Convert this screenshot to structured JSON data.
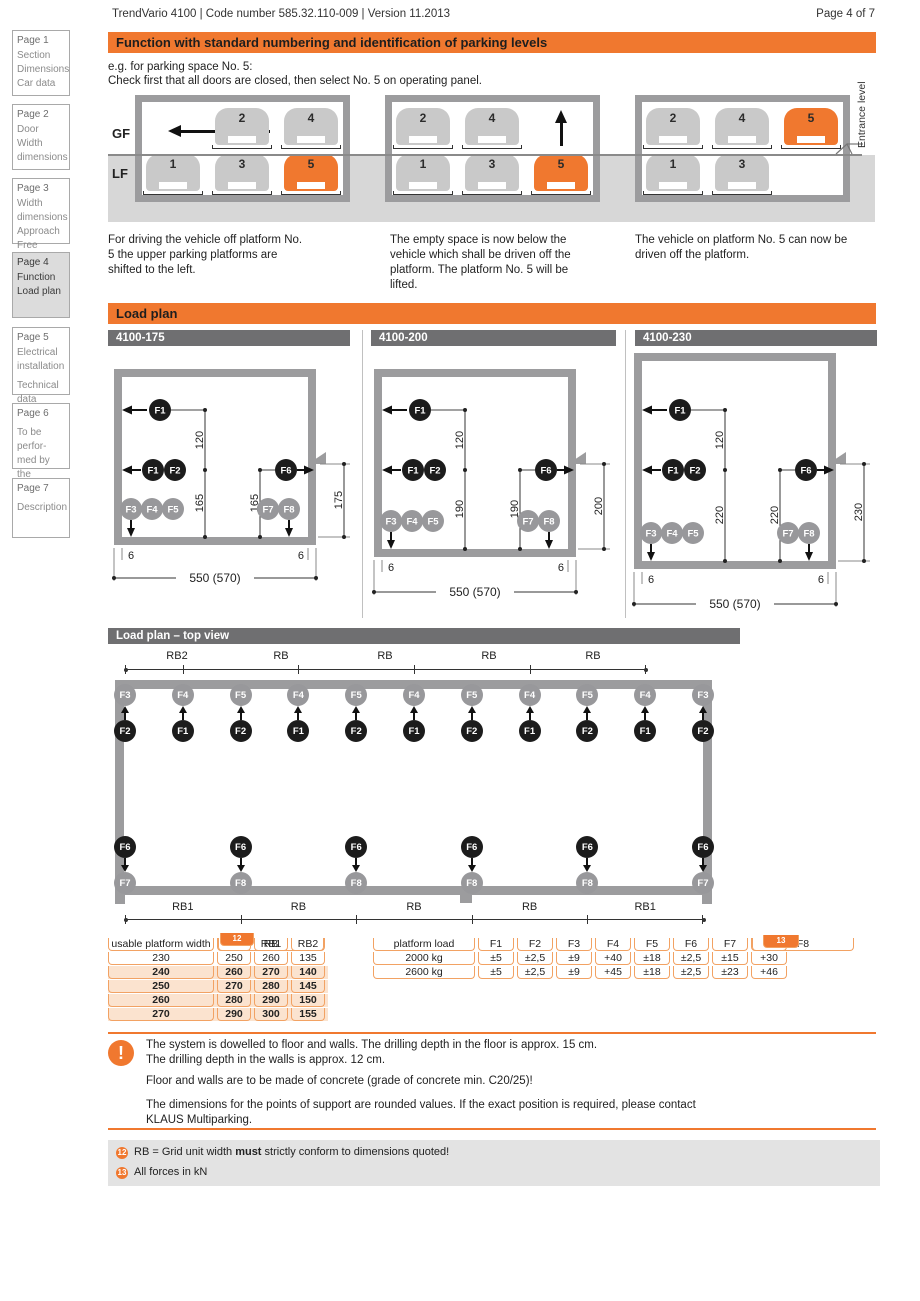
{
  "header": {
    "left": "TrendVario 4100 | Code number 585.32.110-009 | Version 11.2013",
    "right": "Page 4 of 7"
  },
  "colors": {
    "orange": "#f0782f",
    "peach": "#fbe3cf",
    "wall_gray": "#9c9c9e",
    "ground_gray": "#d7d7d7",
    "bar_gray": "#6f6f71"
  },
  "sidebar": [
    {
      "title": "Page 1",
      "lines": [
        "Section",
        "Dimensions",
        "Car data"
      ]
    },
    {
      "title": "Page 2",
      "lines": [
        "Door",
        "Width",
        "dimensions"
      ]
    },
    {
      "title": "Page 3",
      "lines": [
        "Width",
        "dimensions",
        "Approach",
        "Free spaces"
      ]
    },
    {
      "title": "Page 4",
      "lines": [
        "Function",
        "Load plan"
      ]
    },
    {
      "title": "Page 5",
      "lines": [
        "Electrical",
        "installation",
        "Technical",
        "data"
      ]
    },
    {
      "title": "Page 6",
      "lines": [
        "To be perfor-",
        "med by the",
        "customer"
      ]
    },
    {
      "title": "Page 7",
      "lines": [
        "Description"
      ]
    }
  ],
  "function": {
    "title": "Function with standard numbering and identification of parking levels",
    "intro1": "e.g. for parking space No. 5:",
    "intro2": "Check first that all doors are closed, then select No. 5 on operating panel.",
    "gf": "GF",
    "lf": "LF",
    "entrance": "Entrance level",
    "diagrams": [
      {
        "gf": [
          "2",
          "4"
        ],
        "lf": [
          "1",
          "3",
          "5"
        ]
      },
      {
        "gf": [
          "2",
          "4"
        ],
        "lf": [
          "1",
          "3",
          "5"
        ]
      },
      {
        "gf": [
          "2",
          "4",
          "5"
        ],
        "lf": [
          "1",
          "3"
        ]
      }
    ],
    "captions": [
      "For driving the vehicle off platform No. 5 the upper parking platforms are shifted to the left.",
      "The empty space is now below the vehicle which shall be driven off the platform. The platform No. 5 will be lifted.",
      "The vehicle on platform No. 5 can now be driven off the platform."
    ]
  },
  "labels": {
    "f1": "F1",
    "f2": "F2",
    "f3": "F3",
    "f4": "F4",
    "f5": "F5",
    "f6": "F6",
    "f7": "F7",
    "f8": "F8"
  },
  "loadplan": {
    "title": "Load plan",
    "panels": [
      {
        "name": "4100-175",
        "dim_gap": "120",
        "dim_left": "165",
        "dim_mid": "165",
        "dim_right": "175",
        "wall_left": "6",
        "wall_right": "6",
        "total": "550 (570)"
      },
      {
        "name": "4100-200",
        "dim_gap": "120",
        "dim_left": "190",
        "dim_mid": "190",
        "dim_right": "200",
        "wall_left": "6",
        "wall_right": "6",
        "total": "550 (570)"
      },
      {
        "name": "4100-230",
        "dim_gap": "120",
        "dim_left": "220",
        "dim_mid": "220",
        "dim_right": "230",
        "wall_left": "6",
        "wall_right": "6",
        "total": "550 (570)"
      }
    ]
  },
  "topview": {
    "title": "Load plan – top view",
    "dims_top": [
      "RB2",
      "RB",
      "RB",
      "RB",
      "RB"
    ],
    "dims_bottom": [
      "RB1",
      "RB",
      "RB",
      "RB",
      "RB1"
    ],
    "cols_top": [
      {
        "gray": "F3",
        "black": "F2"
      },
      {
        "gray": "F4",
        "black": "F1"
      },
      {
        "gray": "F5",
        "black": "F2"
      },
      {
        "gray": "F4",
        "black": "F1"
      },
      {
        "gray": "F5",
        "black": "F2"
      },
      {
        "gray": "F4",
        "black": "F1"
      },
      {
        "gray": "F5",
        "black": "F2"
      },
      {
        "gray": "F4",
        "black": "F1"
      },
      {
        "gray": "F5",
        "black": "F2"
      },
      {
        "gray": "F4",
        "black": "F1"
      },
      {
        "gray": "F3",
        "black": "F2"
      }
    ],
    "cols_bottom": [
      {
        "black": "F6",
        "gray": "F7"
      },
      {
        "black": "F6",
        "gray": "F8"
      },
      {
        "black": "F6",
        "gray": "F8"
      },
      {
        "black": "F6",
        "gray": "F8"
      },
      {
        "black": "F6",
        "gray": "F8"
      },
      {
        "black": "F6",
        "gray": "F7"
      }
    ]
  },
  "tables": {
    "left": {
      "headers": [
        "usable platform width",
        "RB",
        "RB1",
        "RB2"
      ],
      "badge": "12",
      "rows": [
        [
          "230",
          "250",
          "260",
          "135"
        ],
        [
          "240",
          "260",
          "270",
          "140"
        ],
        [
          "250",
          "270",
          "280",
          "145"
        ],
        [
          "260",
          "280",
          "290",
          "150"
        ],
        [
          "270",
          "290",
          "300",
          "155"
        ]
      ]
    },
    "right": {
      "headers": [
        "platform load",
        "F1",
        "F2",
        "F3",
        "F4",
        "F5",
        "F6",
        "F7",
        "F8"
      ],
      "badge": "13",
      "rows": [
        [
          "2000 kg",
          "±5",
          "±2,5",
          "±9",
          "+40",
          "±18",
          "±2,5",
          "±15",
          "+30"
        ],
        [
          "2600 kg",
          "±5",
          "±2,5",
          "±9",
          "+45",
          "±18",
          "±2,5",
          "±23",
          "+46"
        ]
      ]
    }
  },
  "notes": {
    "p1a": "The system is dowelled to floor and walls. The drilling depth in the floor is approx. 15 cm.",
    "p1b": "The drilling depth in the walls is approx. 12 cm.",
    "p2": "Floor and walls are to be made of concrete (grade of concrete min. C20/25)!",
    "p3a": "The dimensions for the points of support are rounded values. If the exact position is required, please contact",
    "p3b": "KLAUS Multiparking.",
    "warn_mark": "!"
  },
  "footnotes": [
    {
      "badge": "12",
      "pre": "RB = Grid unit width ",
      "bold": "must",
      "post": " strictly conform to dimensions quoted!"
    },
    {
      "badge": "13",
      "pre": "All forces in kN",
      "bold": "",
      "post": ""
    }
  ]
}
